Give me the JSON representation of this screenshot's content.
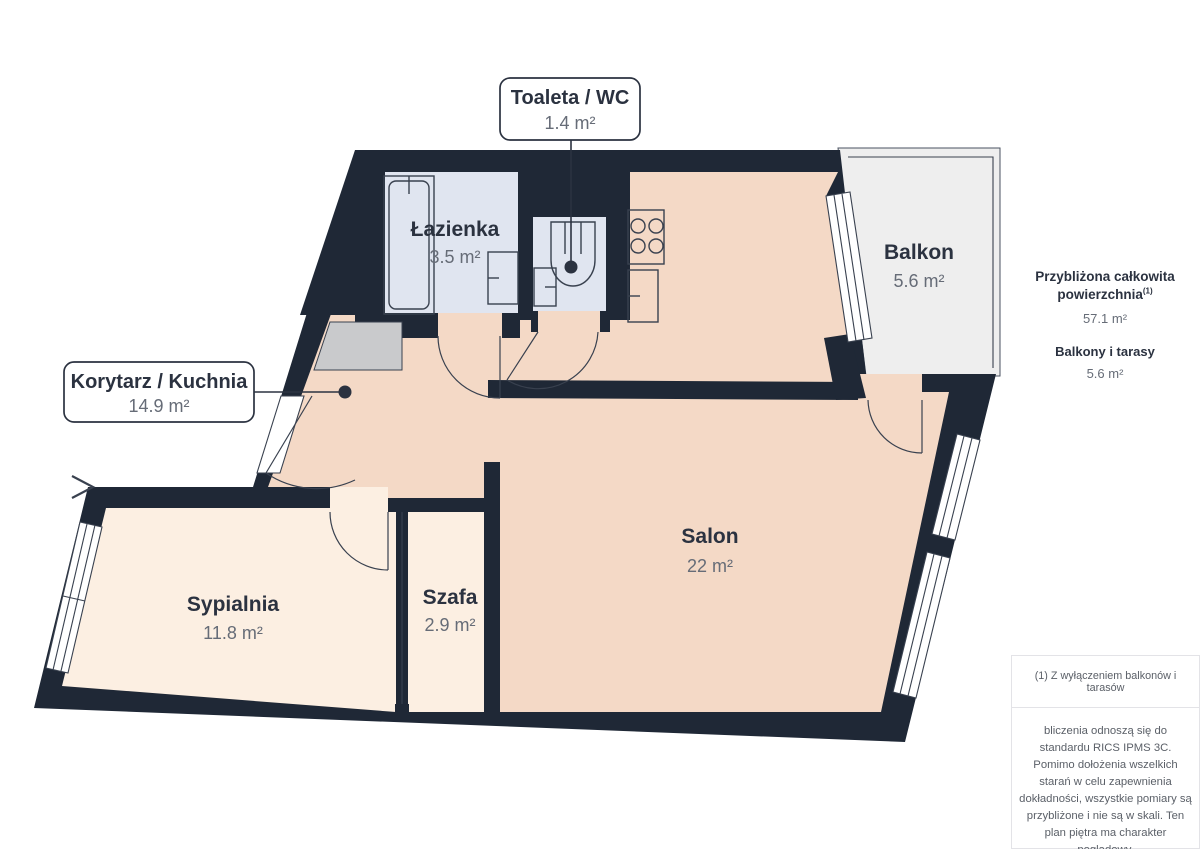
{
  "colors": {
    "wall": "#1f2836",
    "peach": "#f4d9c6",
    "cream": "#fcefe2",
    "wet": "#e0e5f0",
    "balcony": "#eeeeee",
    "mat": "#c9cacc",
    "line": "#39414f",
    "ink": "#2b3240",
    "sub": "#666c77"
  },
  "plan": {
    "rooms": [
      {
        "id": "toaleta",
        "label": "Toaleta / WC",
        "area": "1.4 m²"
      },
      {
        "id": "lazienka",
        "label": "Łazienka",
        "area": "3.5 m²"
      },
      {
        "id": "korytarz",
        "label": "Korytarz / Kuchnia",
        "area": "14.9 m²"
      },
      {
        "id": "balkon",
        "label": "Balkon",
        "area": "5.6 m²"
      },
      {
        "id": "salon",
        "label": "Salon",
        "area": "22 m²"
      },
      {
        "id": "sypialnia",
        "label": "Sypialnia",
        "area": "11.8 m²"
      },
      {
        "id": "szafa",
        "label": "Szafa",
        "area": "2.9 m²"
      }
    ]
  },
  "sidebar": {
    "total_label": "Przybliżona całkowita powierzchnia",
    "total_sup": "(1)",
    "total_value": "57.1 m²",
    "balconies_label": "Balkony i tarasy",
    "balconies_value": "5.6 m²",
    "footnote": "(1) Z wyłączeniem balkonów i tarasów",
    "disclaimer": "bliczenia odnoszą się do standardu RICS IPMS 3C. Pomimo dołożenia wszelkich starań w celu zapewnienia dokładności, wszystkie pomiary są przybliżone i nie są w skali. Ten plan piętra ma charakter poglądowy.",
    "brand_name": "GIRAFFE",
    "brand_suffix": "360"
  }
}
